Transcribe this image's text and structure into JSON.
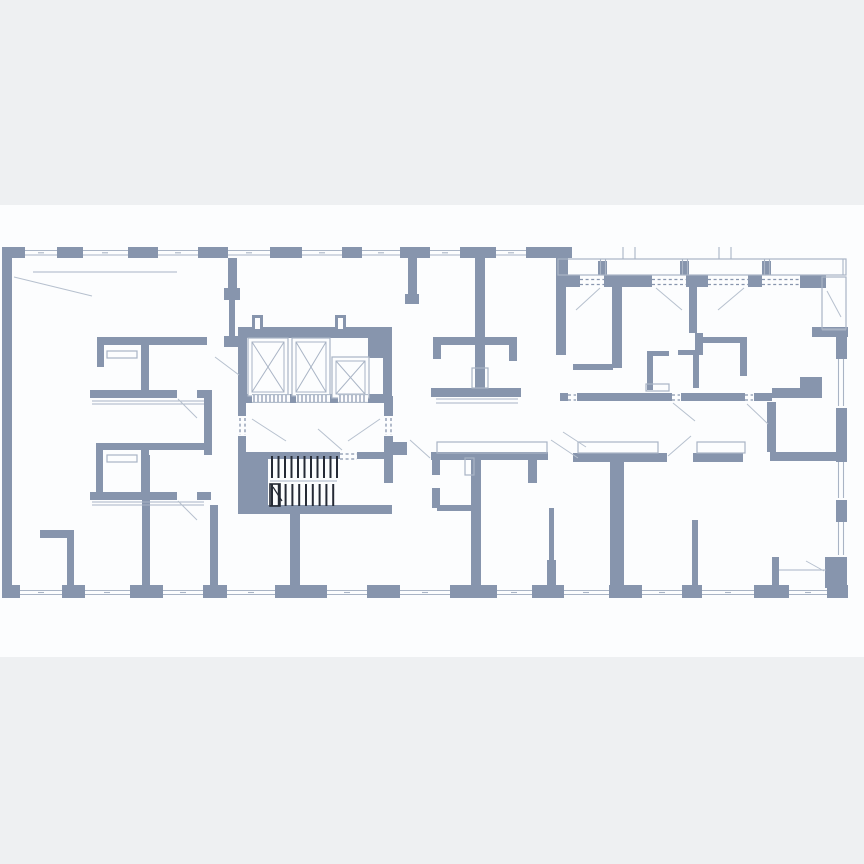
{
  "colors": {
    "outer_bg": "#eef0f2",
    "plan_bg": "#fcfdfe",
    "wall": "#8795ad",
    "thin": "#a9b4c5",
    "swing": "#b6c0ce",
    "dark": "#252a35"
  },
  "floorplan": {
    "canvas": {
      "width": 864,
      "height": 864
    },
    "bands": [
      [
        0,
        0,
        864,
        205,
        "outer_bg"
      ],
      [
        0,
        205,
        864,
        452,
        "plan_bg"
      ],
      [
        0,
        657,
        864,
        207,
        "outer_bg"
      ]
    ],
    "walls": [
      [
        2,
        247,
        10,
        348
      ],
      [
        2,
        247,
        23,
        11
      ],
      [
        57,
        247,
        26,
        11
      ],
      [
        128,
        247,
        30,
        11
      ],
      [
        198,
        247,
        30,
        11
      ],
      [
        270,
        247,
        32,
        11
      ],
      [
        342,
        247,
        20,
        11
      ],
      [
        400,
        247,
        30,
        11
      ],
      [
        460,
        247,
        36,
        11
      ],
      [
        526,
        247,
        46,
        11
      ],
      [
        556,
        258,
        12,
        20
      ],
      [
        556,
        275,
        24,
        12
      ],
      [
        604,
        275,
        48,
        12
      ],
      [
        686,
        275,
        22,
        12
      ],
      [
        748,
        275,
        14,
        12
      ],
      [
        800,
        275,
        26,
        13
      ],
      [
        598,
        261,
        9,
        14
      ],
      [
        680,
        261,
        9,
        14
      ],
      [
        762,
        261,
        9,
        14
      ],
      [
        812,
        327,
        36,
        10
      ],
      [
        836,
        327,
        11,
        32
      ],
      [
        836,
        408,
        11,
        54
      ],
      [
        836,
        500,
        11,
        22
      ],
      [
        825,
        557,
        22,
        31
      ],
      [
        2,
        585,
        18,
        13
      ],
      [
        62,
        585,
        23,
        13
      ],
      [
        130,
        585,
        33,
        13
      ],
      [
        203,
        585,
        24,
        13
      ],
      [
        275,
        585,
        52,
        13
      ],
      [
        367,
        585,
        33,
        13
      ],
      [
        450,
        585,
        47,
        13
      ],
      [
        532,
        585,
        32,
        13
      ],
      [
        609,
        585,
        33,
        13
      ],
      [
        682,
        585,
        20,
        13
      ],
      [
        754,
        585,
        35,
        13
      ],
      [
        827,
        585,
        21,
        13
      ],
      [
        228,
        258,
        9,
        42
      ],
      [
        224,
        288,
        16,
        12
      ],
      [
        229,
        300,
        6,
        38
      ],
      [
        224,
        336,
        15,
        11
      ],
      [
        97,
        337,
        110,
        8
      ],
      [
        97,
        345,
        7,
        22
      ],
      [
        141,
        337,
        8,
        56
      ],
      [
        90,
        390,
        121,
        8
      ],
      [
        204,
        390,
        8,
        65
      ],
      [
        96,
        443,
        7,
        57
      ],
      [
        97,
        443,
        110,
        7
      ],
      [
        141,
        443,
        8,
        50
      ],
      [
        90,
        492,
        121,
        8
      ],
      [
        40,
        530,
        34,
        8
      ],
      [
        67,
        538,
        7,
        50
      ],
      [
        142,
        455,
        8,
        133
      ],
      [
        210,
        505,
        8,
        83
      ],
      [
        238,
        327,
        154,
        11
      ],
      [
        252,
        315,
        11,
        13
      ],
      [
        335,
        315,
        11,
        13
      ],
      [
        238,
        338,
        9,
        58
      ],
      [
        383,
        338,
        9,
        58
      ],
      [
        368,
        338,
        24,
        20
      ],
      [
        238,
        394,
        154,
        9
      ],
      [
        238,
        396,
        8,
        56
      ],
      [
        384,
        396,
        9,
        56
      ],
      [
        238,
        452,
        30,
        61
      ],
      [
        243,
        452,
        97,
        7
      ],
      [
        357,
        452,
        35,
        7
      ],
      [
        384,
        452,
        9,
        31
      ],
      [
        238,
        505,
        154,
        9
      ],
      [
        290,
        514,
        10,
        79
      ],
      [
        392,
        442,
        15,
        13
      ],
      [
        408,
        258,
        9,
        40
      ],
      [
        405,
        294,
        14,
        10
      ],
      [
        475,
        258,
        10,
        79
      ],
      [
        433,
        337,
        84,
        8
      ],
      [
        433,
        345,
        8,
        14
      ],
      [
        509,
        345,
        8,
        16
      ],
      [
        475,
        345,
        10,
        43
      ],
      [
        431,
        388,
        90,
        9
      ],
      [
        431,
        452,
        117,
        8
      ],
      [
        432,
        460,
        8,
        15
      ],
      [
        528,
        460,
        9,
        23
      ],
      [
        432,
        488,
        8,
        20
      ],
      [
        437,
        505,
        35,
        6
      ],
      [
        471,
        455,
        10,
        133
      ],
      [
        549,
        508,
        5,
        52
      ],
      [
        547,
        560,
        9,
        28
      ],
      [
        556,
        287,
        10,
        68
      ],
      [
        612,
        287,
        10,
        81
      ],
      [
        573,
        364,
        40,
        6
      ],
      [
        689,
        287,
        8,
        46
      ],
      [
        695,
        333,
        8,
        22
      ],
      [
        703,
        337,
        44,
        6
      ],
      [
        740,
        338,
        7,
        38
      ],
      [
        647,
        351,
        6,
        39
      ],
      [
        647,
        351,
        22,
        5
      ],
      [
        678,
        350,
        22,
        5
      ],
      [
        693,
        350,
        6,
        38
      ],
      [
        560,
        393,
        212,
        8
      ],
      [
        772,
        388,
        50,
        10
      ],
      [
        800,
        377,
        22,
        13
      ],
      [
        573,
        453,
        94,
        9
      ],
      [
        693,
        453,
        50,
        9
      ],
      [
        770,
        452,
        68,
        9
      ],
      [
        610,
        462,
        14,
        126
      ],
      [
        767,
        402,
        9,
        50
      ],
      [
        692,
        520,
        6,
        68
      ],
      [
        772,
        557,
        7,
        31
      ]
    ],
    "gaps": [
      [
        177,
        389,
        20,
        10
      ],
      [
        177,
        491,
        20,
        10
      ],
      [
        237,
        416,
        10,
        20
      ],
      [
        383,
        416,
        10,
        20
      ],
      [
        568,
        392,
        9,
        10
      ],
      [
        672,
        392,
        9,
        10
      ],
      [
        745,
        392,
        9,
        10
      ],
      [
        255,
        318,
        5,
        11
      ],
      [
        338,
        318,
        5,
        11
      ]
    ],
    "outline_rects": [
      [
        558,
        259,
        288,
        16
      ],
      [
        822,
        277,
        24,
        52
      ],
      [
        437,
        442,
        110,
        11
      ],
      [
        578,
        442,
        80,
        11
      ],
      [
        697,
        442,
        48,
        11
      ],
      [
        646,
        384,
        23,
        7
      ],
      [
        472,
        368,
        16,
        20
      ],
      [
        465,
        458,
        9,
        17
      ],
      [
        107,
        351,
        30,
        7
      ],
      [
        107,
        455,
        30,
        7
      ]
    ],
    "elevators": [
      [
        248,
        338,
        40,
        58
      ],
      [
        292,
        338,
        38,
        58
      ],
      [
        332,
        357,
        37,
        41
      ]
    ],
    "lines": [
      [
        25,
        250.5,
        57,
        250.5
      ],
      [
        25,
        255,
        57,
        255
      ],
      [
        83,
        250.5,
        128,
        250.5
      ],
      [
        83,
        255,
        128,
        255
      ],
      [
        158,
        250.5,
        198,
        250.5
      ],
      [
        158,
        255,
        198,
        255
      ],
      [
        228,
        250.5,
        270,
        250.5
      ],
      [
        228,
        255,
        270,
        255
      ],
      [
        302,
        250.5,
        342,
        250.5
      ],
      [
        302,
        255,
        342,
        255
      ],
      [
        362,
        250.5,
        400,
        250.5
      ],
      [
        362,
        255,
        400,
        255
      ],
      [
        430,
        250.5,
        460,
        250.5
      ],
      [
        430,
        255,
        460,
        255
      ],
      [
        496,
        250.5,
        526,
        250.5
      ],
      [
        496,
        255,
        526,
        255
      ],
      [
        38,
        252.8,
        44,
        252.8
      ],
      [
        102,
        252.8,
        108,
        252.8
      ],
      [
        175,
        252.8,
        181,
        252.8
      ],
      [
        246,
        252.8,
        252,
        252.8
      ],
      [
        319,
        252.8,
        325,
        252.8
      ],
      [
        378,
        252.8,
        384,
        252.8
      ],
      [
        442,
        252.8,
        448,
        252.8
      ],
      [
        508,
        252.8,
        514,
        252.8
      ],
      [
        20,
        590.5,
        62,
        590.5
      ],
      [
        20,
        594.5,
        62,
        594.5
      ],
      [
        85,
        590.5,
        130,
        590.5
      ],
      [
        85,
        594.5,
        130,
        594.5
      ],
      [
        163,
        590.5,
        203,
        590.5
      ],
      [
        163,
        594.5,
        203,
        594.5
      ],
      [
        227,
        590.5,
        275,
        590.5
      ],
      [
        227,
        594.5,
        275,
        594.5
      ],
      [
        327,
        590.5,
        367,
        590.5
      ],
      [
        327,
        594.5,
        367,
        594.5
      ],
      [
        400,
        590.5,
        450,
        590.5
      ],
      [
        400,
        594.5,
        450,
        594.5
      ],
      [
        497,
        590.5,
        532,
        590.5
      ],
      [
        497,
        594.5,
        532,
        594.5
      ],
      [
        564,
        590.5,
        609,
        590.5
      ],
      [
        564,
        594.5,
        609,
        594.5
      ],
      [
        642,
        590.5,
        682,
        590.5
      ],
      [
        642,
        594.5,
        682,
        594.5
      ],
      [
        702,
        590.5,
        754,
        590.5
      ],
      [
        702,
        594.5,
        754,
        594.5
      ],
      [
        789,
        590.5,
        827,
        590.5
      ],
      [
        789,
        594.5,
        827,
        594.5
      ],
      [
        38,
        592.5,
        44,
        592.5
      ],
      [
        104,
        592.5,
        110,
        592.5
      ],
      [
        180,
        592.5,
        186,
        592.5
      ],
      [
        248,
        592.5,
        254,
        592.5
      ],
      [
        344,
        592.5,
        350,
        592.5
      ],
      [
        422,
        592.5,
        428,
        592.5
      ],
      [
        511,
        592.5,
        517,
        592.5
      ],
      [
        583,
        592.5,
        589,
        592.5
      ],
      [
        659,
        592.5,
        665,
        592.5
      ],
      [
        725,
        592.5,
        731,
        592.5
      ],
      [
        805,
        592.5,
        811,
        592.5
      ],
      [
        838.5,
        359,
        838.5,
        406
      ],
      [
        843.5,
        359,
        843.5,
        406
      ],
      [
        838.5,
        462,
        838.5,
        498
      ],
      [
        843.5,
        462,
        843.5,
        498
      ],
      [
        838.5,
        522,
        838.5,
        555
      ],
      [
        843.5,
        522,
        843.5,
        555
      ],
      [
        623,
        247,
        623,
        259
      ],
      [
        635,
        247,
        635,
        259
      ],
      [
        719,
        247,
        719,
        259
      ],
      [
        731,
        247,
        731,
        259
      ],
      [
        600.5,
        259,
        600.5,
        275
      ],
      [
        605.5,
        259,
        605.5,
        275
      ],
      [
        682.5,
        259,
        682.5,
        275
      ],
      [
        687.5,
        259,
        687.5,
        275
      ],
      [
        764.5,
        259,
        764.5,
        275
      ],
      [
        769.5,
        259,
        769.5,
        275
      ],
      [
        843,
        259,
        843,
        275
      ],
      [
        822,
        330,
        846,
        330
      ],
      [
        33,
        272,
        177,
        272
      ],
      [
        92,
        401,
        204,
        401
      ],
      [
        92,
        404,
        204,
        404
      ],
      [
        92,
        502,
        204,
        502
      ],
      [
        92,
        505,
        204,
        505
      ],
      [
        436,
        399,
        518,
        399
      ],
      [
        436,
        403,
        518,
        403
      ],
      [
        270,
        481,
        337,
        481
      ],
      [
        779,
        570,
        826,
        570
      ]
    ],
    "dashed_lines": [
      [
        240,
        418,
        240,
        435
      ],
      [
        245,
        418,
        245,
        435
      ],
      [
        386,
        418,
        386,
        435
      ],
      [
        391,
        418,
        391,
        435
      ],
      [
        340,
        454,
        357,
        454
      ],
      [
        340,
        459,
        357,
        459
      ],
      [
        580,
        279.5,
        604,
        279.5
      ],
      [
        580,
        284.5,
        604,
        284.5
      ],
      [
        652,
        279.5,
        686,
        279.5
      ],
      [
        652,
        284.5,
        686,
        284.5
      ],
      [
        708,
        279.5,
        748,
        279.5
      ],
      [
        708,
        284.5,
        748,
        284.5
      ],
      [
        762,
        279.5,
        800,
        279.5
      ],
      [
        762,
        284.5,
        800,
        284.5
      ],
      [
        568,
        395,
        576,
        395
      ],
      [
        568,
        400,
        576,
        400
      ],
      [
        672,
        395,
        680,
        395
      ],
      [
        672,
        400,
        680,
        400
      ],
      [
        745,
        395,
        753,
        395
      ],
      [
        745,
        400,
        753,
        400
      ]
    ],
    "sill_hatches": [
      [
        252,
        394,
        38,
        9
      ],
      [
        296,
        394,
        34,
        9
      ],
      [
        338,
        394,
        30,
        9
      ]
    ],
    "stairs": {
      "flight_up": {
        "x0": 272,
        "count": 11,
        "step": 6.5,
        "y1": 456,
        "y2": 478
      },
      "flight_down": {
        "x0": 272,
        "count": 10,
        "step": 6.8,
        "y1": 484,
        "y2": 506
      },
      "start_box": [
        270,
        484,
        10,
        22
      ],
      "arrow": [
        273,
        487,
        282,
        501
      ]
    },
    "door_swings": [
      [
        14,
        277,
        92,
        296
      ],
      [
        215,
        357,
        239,
        375
      ],
      [
        252,
        419,
        286,
        441
      ],
      [
        380,
        419,
        348,
        441
      ],
      [
        342,
        450,
        318,
        429
      ],
      [
        410,
        440,
        430,
        458
      ],
      [
        551,
        440,
        578,
        458
      ],
      [
        600,
        288,
        576,
        310
      ],
      [
        656,
        288,
        682,
        310
      ],
      [
        744,
        288,
        718,
        310
      ],
      [
        827,
        291,
        841,
        317
      ],
      [
        563,
        432,
        586,
        447
      ],
      [
        673,
        403,
        695,
        421
      ],
      [
        747,
        404,
        768,
        424
      ],
      [
        668,
        456,
        691,
        436
      ],
      [
        806,
        561,
        824,
        571
      ],
      [
        178,
        399,
        197,
        418
      ],
      [
        178,
        501,
        197,
        520
      ]
    ]
  }
}
